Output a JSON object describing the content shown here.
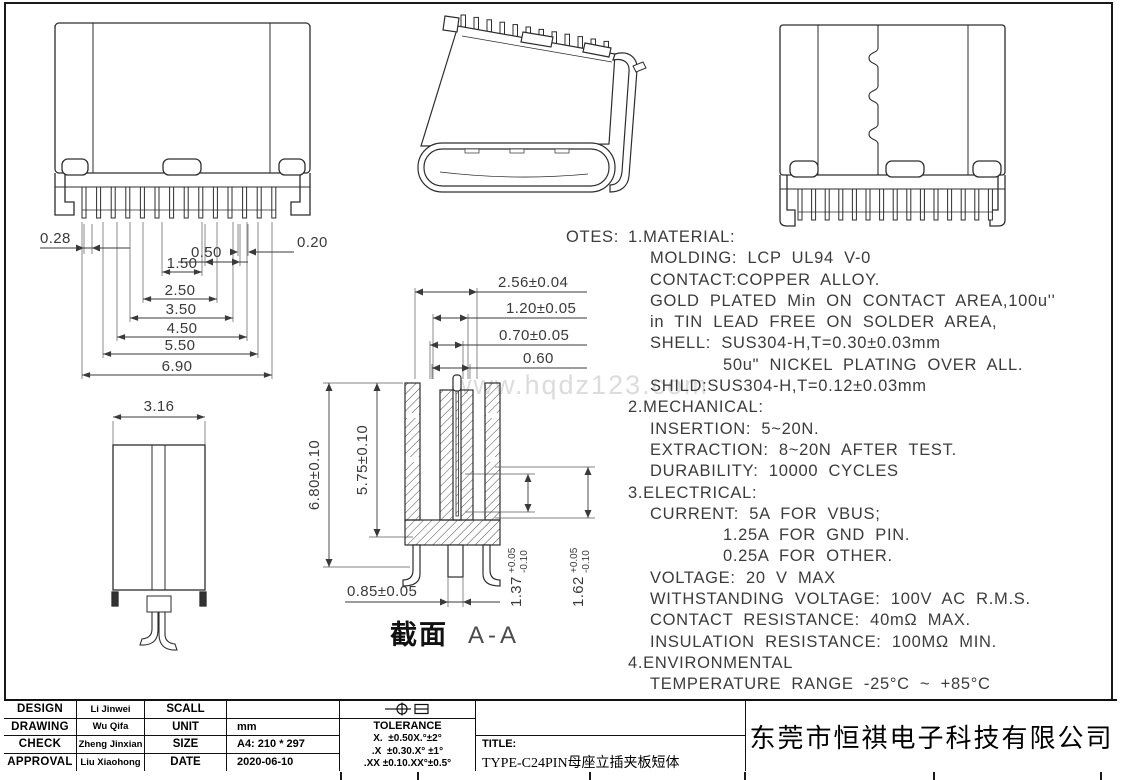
{
  "watermark": "www.hqdz123.com",
  "front_view": {
    "dims": {
      "pin_offset": "0.28",
      "edge_gap": "0.20",
      "pin_gap": "0.50",
      "span1": "1.50",
      "span2": "2.50",
      "span3": "3.50",
      "span4": "4.50",
      "span5": "5.50",
      "overall": "6.90"
    }
  },
  "side_view": {
    "dims": {
      "width": "3.16"
    }
  },
  "section_view": {
    "label_cn": "截面",
    "label_en": "A-A",
    "dims": {
      "top1": "2.56±0.04",
      "top2": "1.20±0.05",
      "top3": "0.70±0.05",
      "top4": "0.60",
      "height": "6.80±0.10",
      "inner_height": "5.75±0.10",
      "leg_width": "0.85±0.05",
      "t1_base": "1.37",
      "t1_plus": "+0.05",
      "t1_minus": "-0.10",
      "t2_base": "1.62",
      "t2_plus": "+0.05",
      "t2_minus": "-0.10"
    }
  },
  "notes": {
    "heading": "OTES:",
    "lines": [
      "1.MATERIAL:",
      "MOLDING: LCP UL94 V-0",
      "CONTACT:COPPER ALLOY.",
      "GOLD PLATED Min ON CONTACT AREA,100u''",
      "in TIN LEAD FREE ON SOLDER AREA,",
      "SHELL: SUS304-H,T=0.30±0.03mm",
      "50u\" NICKEL PLATING OVER ALL.",
      "SHILD:SUS304-H,T=0.12±0.03mm",
      "2.MECHANICAL:",
      "INSERTION: 5~20N.",
      "EXTRACTION: 8~20N AFTER TEST.",
      "DURABILITY: 10000 CYCLES",
      "3.ELECTRICAL:",
      "CURRENT: 5A FOR VBUS;",
      "1.25A FOR GND PIN.",
      "0.25A FOR OTHER.",
      "VOLTAGE: 20 V MAX",
      "WITHSTANDING VOLTAGE: 100V AC R.M.S.",
      "CONTACT RESISTANCE: 40mΩ MAX.",
      "INSULATION RESISTANCE: 100MΩ MIN.",
      "4.ENVIRONMENTAL",
      "TEMPERATURE RANGE -25°C ~ +85°C"
    ]
  },
  "title_block": {
    "rows": [
      {
        "label": "DESIGN",
        "name": "Li Jinwei",
        "field": "SCALL",
        "value": ""
      },
      {
        "label": "DRAWING",
        "name": "Wu Qifa",
        "field": "UNIT",
        "value": "mm"
      },
      {
        "label": "CHECK",
        "name": "Zheng Jinxian",
        "field": "SIZE",
        "value": "A4: 210 * 297"
      },
      {
        "label": "APPROVAL",
        "name": "Liu Xiaohong",
        "field": "DATE",
        "value": "2020-06-10"
      }
    ],
    "tolerance": {
      "heading": "TOLERANCE",
      "r1a": "X.  ±0.50",
      "r1b": "X.°±2°",
      "r2a": ".X  ±0.30",
      "r2b": ".X° ±1°",
      "r3a": ".XX ±0.10",
      "r3b": ".XX°±0.5°"
    },
    "title_label": "TITLE:",
    "title_value": "TYPE-C24PIN母座立插夹板短体",
    "company": "东莞市恒祺电子科技有限公司",
    "icons": {
      "projection_symbol": "⊕⊟"
    }
  }
}
